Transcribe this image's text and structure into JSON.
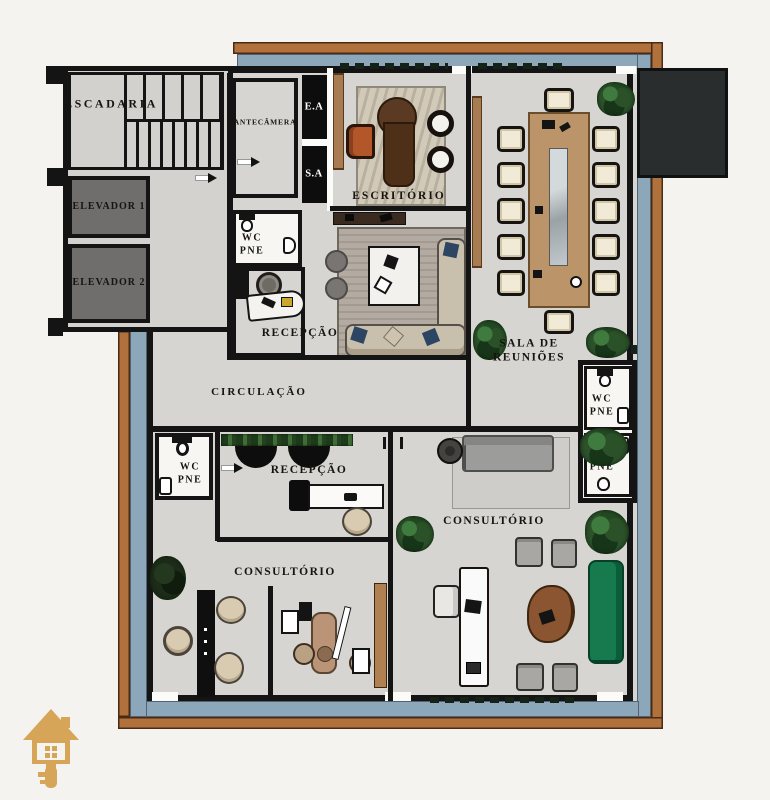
{
  "document": {
    "type": "architectural floor plan",
    "language": "pt-BR"
  },
  "palette": {
    "background": "#f5f3f0",
    "frame_wood": "#b0713c",
    "frame_border_water": "#8ca7ba",
    "floor": "#d7d5d1",
    "wall": "#141414",
    "elevator_fill": "#6f6e6c",
    "service_shaft_black": "#0d0d0d",
    "wood_furniture": "#a87c52",
    "conference_table_wood": "#bb9569",
    "desk_dark_wood": "#55351f",
    "office_chair_orange": "#b3572b",
    "meeting_chair_cream": "#f0ead6",
    "sofa_beige": "#c9bfad",
    "pillow_navy": "#2c4563",
    "sofa_green": "#167a4e",
    "sofa_gray": "#9c9c9a",
    "plant_green": "#2f5c31",
    "wc_floor": "#f7f6f3",
    "logo_gold": "#d6a557"
  },
  "rooms": [
    {
      "id": "escadaria",
      "label": "ESCADARIA"
    },
    {
      "id": "elevador-1",
      "label": "ELEVADOR 1"
    },
    {
      "id": "elevador-2",
      "label": "ELEVADOR 2"
    },
    {
      "id": "antecamera",
      "label": "ANTECÂMERA"
    },
    {
      "id": "ea",
      "label": "E.A"
    },
    {
      "id": "sa",
      "label": "S.A"
    },
    {
      "id": "escritorio",
      "label": "ESCRITÓRIO"
    },
    {
      "id": "wc-pne-superior",
      "line1": "WC",
      "line2": "PNE"
    },
    {
      "id": "recepcao-superior",
      "label": "RECEPÇÃO"
    },
    {
      "id": "sala-de-reunioes",
      "line1": "SALA DE",
      "line2": "REUNIÕES"
    },
    {
      "id": "circulacao",
      "label": "CIRCULAÇÃO"
    },
    {
      "id": "wc-pne-direito-1",
      "line1": "WC",
      "line2": "PNE"
    },
    {
      "id": "wc-pne-direito-2",
      "line1": "WC",
      "line2": "PNE"
    },
    {
      "id": "wc-pne-esquerdo",
      "line1": "WC",
      "line2": "PNE"
    },
    {
      "id": "recepcao-inferior",
      "label": "RECEPÇÃO"
    },
    {
      "id": "consultorio-esquerdo",
      "label": "CONSULTÓRIO"
    },
    {
      "id": "consultorio-direito",
      "label": "CONSULTÓRIO"
    }
  ],
  "logo": {
    "icon": "house-key-icon"
  }
}
